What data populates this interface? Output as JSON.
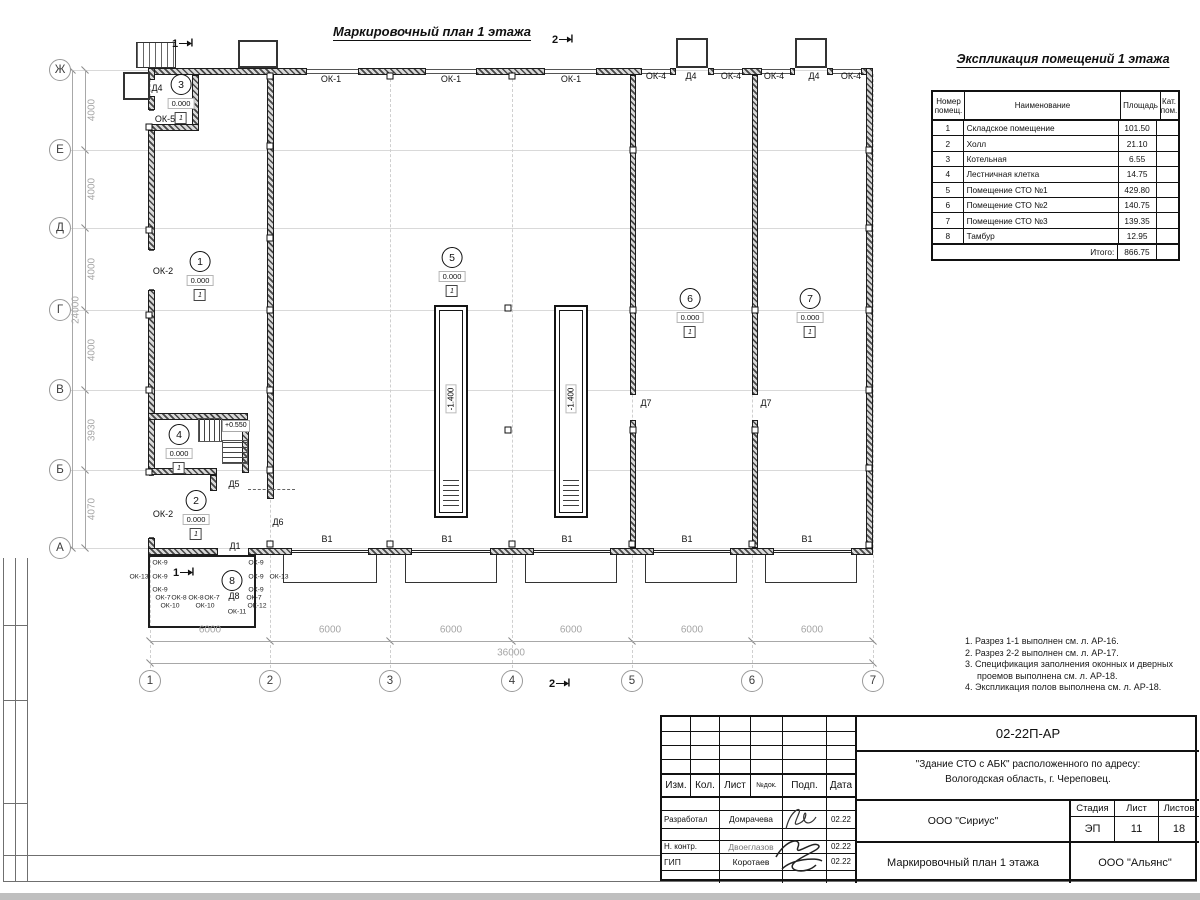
{
  "sheet": {
    "plan_title": "Маркировочный план 1 этажа",
    "table_title": "Экспликация помещений 1 этажа"
  },
  "explication": {
    "headers": {
      "num": "Номер помещ.",
      "name": "Наименование",
      "area": "Площадь",
      "cat": "Кат. пом."
    },
    "rows": [
      {
        "num": "1",
        "name": "Складское помещение",
        "area": "101.50",
        "cat": ""
      },
      {
        "num": "2",
        "name": "Холл",
        "area": "21.10",
        "cat": ""
      },
      {
        "num": "3",
        "name": "Котельная",
        "area": "6.55",
        "cat": ""
      },
      {
        "num": "4",
        "name": "Лестничная клетка",
        "area": "14.75",
        "cat": ""
      },
      {
        "num": "5",
        "name": "Помещение СТО №1",
        "area": "429.80",
        "cat": ""
      },
      {
        "num": "6",
        "name": "Помещение СТО №2",
        "area": "140.75",
        "cat": ""
      },
      {
        "num": "7",
        "name": "Помещение СТО №3",
        "area": "139.35",
        "cat": ""
      },
      {
        "num": "8",
        "name": "Тамбур",
        "area": "12.95",
        "cat": ""
      }
    ],
    "total_label": "Итого:",
    "total_value": "866.75"
  },
  "notes": [
    "1. Разрез 1-1 выполнен см. л. АР-16.",
    "2. Разрез 2-2 выполнен см. л. АР-17.",
    "3. Спецификация заполнения оконных и дверных проемов выполнена см. л. АР-18.",
    "4. Экспликация полов выполнена см. л. АР-18."
  ],
  "title_block": {
    "doc_number": "02-22П-АР",
    "project_line1": "\"Здание СТО с АБК\" расположенного по адресу:",
    "project_line2": "Вологодская область, г. Череповец.",
    "col_izm": "Изм.",
    "col_kol": "Кол.",
    "col_list": "Лист",
    "col_ndok": "№док.",
    "col_podp": "Подп.",
    "col_data": "Дата",
    "rows": [
      {
        "role": "Разработал",
        "name": "Домрачева",
        "date": "02.22"
      },
      {
        "role": "Н. контр.",
        "name": "Двоеглазов",
        "date": "02.22"
      },
      {
        "role": "ГИП",
        "name": "Коротаев",
        "date": "02.22"
      }
    ],
    "org_designer": "ООО \"Сириус\"",
    "org_customer": "ООО \"Альянс\"",
    "stage_label": "Стадия",
    "sheet_label": "Лист",
    "sheets_label": "Листов",
    "stage": "ЭП",
    "sheet_no": "11",
    "sheets_total": "18",
    "drawing_title": "Маркировочный план 1 этажа"
  },
  "plan": {
    "stair_level": "+0.550",
    "grid_h": [
      {
        "x": 71,
        "y": 70,
        "w": 800
      },
      {
        "x": 71,
        "y": 150,
        "w": 800
      },
      {
        "x": 71,
        "y": 228,
        "w": 800
      },
      {
        "x": 71,
        "y": 310,
        "w": 800
      },
      {
        "x": 71,
        "y": 390,
        "w": 800
      },
      {
        "x": 71,
        "y": 470,
        "w": 800
      },
      {
        "x": 71,
        "y": 548,
        "w": 800
      }
    ],
    "grid_v": [
      {
        "x": 150,
        "y": 74,
        "h": 594
      },
      {
        "x": 270,
        "y": 74,
        "h": 594
      },
      {
        "x": 390,
        "y": 74,
        "h": 594
      },
      {
        "x": 512,
        "y": 74,
        "h": 594
      },
      {
        "x": 632,
        "y": 74,
        "h": 594
      },
      {
        "x": 752,
        "y": 74,
        "h": 594
      },
      {
        "x": 873,
        "y": 74,
        "h": 594
      }
    ],
    "axes": [
      {
        "t": "Ж",
        "x": 60,
        "y": 70
      },
      {
        "t": "Е",
        "x": 60,
        "y": 150
      },
      {
        "t": "Д",
        "x": 60,
        "y": 228
      },
      {
        "t": "Г",
        "x": 60,
        "y": 310
      },
      {
        "t": "В",
        "x": 60,
        "y": 390
      },
      {
        "t": "Б",
        "x": 60,
        "y": 470
      },
      {
        "t": "А",
        "x": 60,
        "y": 548
      },
      {
        "t": "1",
        "x": 150,
        "y": 681
      },
      {
        "t": "2",
        "x": 270,
        "y": 681
      },
      {
        "t": "3",
        "x": 390,
        "y": 681
      },
      {
        "t": "4",
        "x": 512,
        "y": 681
      },
      {
        "t": "5",
        "x": 632,
        "y": 681
      },
      {
        "t": "6",
        "x": 752,
        "y": 681
      },
      {
        "t": "7",
        "x": 873,
        "y": 681
      }
    ],
    "dims": [
      {
        "t": "4000",
        "x": 92,
        "y": 110,
        "c": "rot"
      },
      {
        "t": "4000",
        "x": 92,
        "y": 189,
        "c": "rot"
      },
      {
        "t": "4000",
        "x": 92,
        "y": 269,
        "c": "rot"
      },
      {
        "t": "4000",
        "x": 92,
        "y": 350,
        "c": "rot"
      },
      {
        "t": "3930",
        "x": 92,
        "y": 430,
        "c": "rot"
      },
      {
        "t": "4070",
        "x": 92,
        "y": 509,
        "c": "rot"
      },
      {
        "t": "24000",
        "x": 76,
        "y": 310,
        "c": "rot"
      },
      {
        "t": "6000",
        "x": 210,
        "y": 630
      },
      {
        "t": "6000",
        "x": 330,
        "y": 630
      },
      {
        "t": "6000",
        "x": 451,
        "y": 630
      },
      {
        "t": "6000",
        "x": 571,
        "y": 630
      },
      {
        "t": "6000",
        "x": 692,
        "y": 630
      },
      {
        "t": "6000",
        "x": 812,
        "y": 630
      },
      {
        "t": "36000",
        "x": 511,
        "y": 653
      }
    ],
    "ticks": [
      {
        "x": 85,
        "y": 70
      },
      {
        "x": 85,
        "y": 150
      },
      {
        "x": 85,
        "y": 228
      },
      {
        "x": 85,
        "y": 310
      },
      {
        "x": 85,
        "y": 390
      },
      {
        "x": 85,
        "y": 470
      },
      {
        "x": 85,
        "y": 548
      },
      {
        "x": 72,
        "y": 70
      },
      {
        "x": 72,
        "y": 548
      },
      {
        "x": 150,
        "y": 641
      },
      {
        "x": 270,
        "y": 641
      },
      {
        "x": 390,
        "y": 641
      },
      {
        "x": 512,
        "y": 641
      },
      {
        "x": 632,
        "y": 641
      },
      {
        "x": 752,
        "y": 641
      },
      {
        "x": 873,
        "y": 641
      },
      {
        "x": 150,
        "y": 663
      },
      {
        "x": 873,
        "y": 663
      }
    ],
    "walls": [
      {
        "x": 85,
        "y": 70,
        "w": 1,
        "h": 478,
        "c": "dlv"
      },
      {
        "x": 72,
        "y": 70,
        "w": 1,
        "h": 478,
        "c": "dlv"
      },
      {
        "x": 150,
        "y": 641,
        "w": 723,
        "h": 1,
        "c": "dlh"
      },
      {
        "x": 150,
        "y": 663,
        "w": 723,
        "h": 1,
        "c": "dlh"
      },
      {
        "x": 150,
        "y": 68,
        "w": 157,
        "h": 7,
        "c": "wh"
      },
      {
        "x": 358,
        "y": 68,
        "w": 68,
        "h": 7,
        "c": "wh"
      },
      {
        "x": 476,
        "y": 68,
        "w": 69,
        "h": 7,
        "c": "wh"
      },
      {
        "x": 596,
        "y": 68,
        "w": 46,
        "h": 7,
        "c": "wh"
      },
      {
        "x": 670,
        "y": 68,
        "w": 6,
        "h": 7,
        "c": "wh"
      },
      {
        "x": 708,
        "y": 68,
        "w": 6,
        "h": 7,
        "c": "wh"
      },
      {
        "x": 742,
        "y": 68,
        "w": 20,
        "h": 7,
        "c": "wh"
      },
      {
        "x": 790,
        "y": 68,
        "w": 5,
        "h": 7,
        "c": "wh"
      },
      {
        "x": 827,
        "y": 68,
        "w": 6,
        "h": 7,
        "c": "wh"
      },
      {
        "x": 861,
        "y": 68,
        "w": 12,
        "h": 7,
        "c": "wh"
      },
      {
        "x": 307,
        "y": 69,
        "w": 51,
        "h": 5,
        "c": "wt"
      },
      {
        "x": 426,
        "y": 69,
        "w": 50,
        "h": 5,
        "c": "wt"
      },
      {
        "x": 545,
        "y": 69,
        "w": 51,
        "h": 5,
        "c": "wt"
      },
      {
        "x": 642,
        "y": 69,
        "w": 28,
        "h": 5,
        "c": "wt"
      },
      {
        "x": 714,
        "y": 69,
        "w": 28,
        "h": 5,
        "c": "wt"
      },
      {
        "x": 762,
        "y": 69,
        "w": 28,
        "h": 5,
        "c": "wt"
      },
      {
        "x": 833,
        "y": 69,
        "w": 28,
        "h": 5,
        "c": "wt"
      },
      {
        "x": 148,
        "y": 68,
        "w": 7,
        "h": 12,
        "c": "wh"
      },
      {
        "x": 148,
        "y": 96,
        "w": 7,
        "h": 14,
        "c": "wh"
      },
      {
        "x": 148,
        "y": 127,
        "w": 7,
        "h": 123,
        "c": "wh"
      },
      {
        "x": 148,
        "y": 290,
        "w": 7,
        "h": 185,
        "c": "wh"
      },
      {
        "x": 148,
        "y": 538,
        "w": 7,
        "h": 17,
        "c": "wh"
      },
      {
        "x": 149,
        "y": 110,
        "w": 5,
        "h": 17,
        "c": "wt"
      },
      {
        "x": 149,
        "y": 250,
        "w": 5,
        "h": 40,
        "c": "wt"
      },
      {
        "x": 149,
        "y": 475,
        "w": 5,
        "h": 63,
        "c": "wt"
      },
      {
        "x": 866,
        "y": 68,
        "w": 7,
        "h": 487,
        "c": "wh"
      },
      {
        "x": 148,
        "y": 548,
        "w": 70,
        "h": 7,
        "c": "wh"
      },
      {
        "x": 248,
        "y": 548,
        "w": 44,
        "h": 7,
        "c": "wh"
      },
      {
        "x": 368,
        "y": 548,
        "w": 44,
        "h": 7,
        "c": "wh"
      },
      {
        "x": 490,
        "y": 548,
        "w": 44,
        "h": 7,
        "c": "wh"
      },
      {
        "x": 610,
        "y": 548,
        "w": 44,
        "h": 7,
        "c": "wh"
      },
      {
        "x": 730,
        "y": 548,
        "w": 44,
        "h": 7,
        "c": "wh"
      },
      {
        "x": 851,
        "y": 548,
        "w": 22,
        "h": 7,
        "c": "wh"
      },
      {
        "x": 292,
        "y": 550,
        "w": 76,
        "h": 3,
        "c": "gate"
      },
      {
        "x": 412,
        "y": 550,
        "w": 78,
        "h": 3,
        "c": "gate"
      },
      {
        "x": 534,
        "y": 550,
        "w": 76,
        "h": 3,
        "c": "gate"
      },
      {
        "x": 654,
        "y": 550,
        "w": 76,
        "h": 3,
        "c": "gate"
      },
      {
        "x": 774,
        "y": 550,
        "w": 77,
        "h": 3,
        "c": "gate"
      },
      {
        "x": 283,
        "y": 555,
        "w": 94,
        "h": 28,
        "c": "apron"
      },
      {
        "x": 405,
        "y": 555,
        "w": 92,
        "h": 28,
        "c": "apron"
      },
      {
        "x": 525,
        "y": 555,
        "w": 92,
        "h": 28,
        "c": "apron"
      },
      {
        "x": 645,
        "y": 555,
        "w": 92,
        "h": 28,
        "c": "apron"
      },
      {
        "x": 765,
        "y": 555,
        "w": 92,
        "h": 28,
        "c": "apron"
      },
      {
        "x": 148,
        "y": 555,
        "w": 108,
        "h": 73,
        "c": "tam"
      },
      {
        "x": 267,
        "y": 75,
        "w": 7,
        "h": 424,
        "c": "wh"
      },
      {
        "x": 630,
        "y": 75,
        "w": 6,
        "h": 320,
        "c": "wh"
      },
      {
        "x": 630,
        "y": 420,
        "w": 6,
        "h": 128,
        "c": "wh"
      },
      {
        "x": 752,
        "y": 75,
        "w": 6,
        "h": 320,
        "c": "wh"
      },
      {
        "x": 752,
        "y": 420,
        "w": 6,
        "h": 128,
        "c": "wh"
      },
      {
        "x": 192,
        "y": 75,
        "w": 7,
        "h": 53,
        "c": "wh"
      },
      {
        "x": 148,
        "y": 124,
        "w": 51,
        "h": 7,
        "c": "wh"
      },
      {
        "x": 148,
        "y": 413,
        "w": 100,
        "h": 7,
        "c": "wh"
      },
      {
        "x": 242,
        "y": 420,
        "w": 7,
        "h": 53,
        "c": "wh"
      },
      {
        "x": 148,
        "y": 468,
        "w": 69,
        "h": 7,
        "c": "wh"
      },
      {
        "x": 210,
        "y": 475,
        "w": 7,
        "h": 16,
        "c": "wh"
      },
      {
        "x": 248,
        "y": 489,
        "w": 47,
        "h": 2,
        "c": "dash"
      },
      {
        "x": 123,
        "y": 72,
        "w": 27,
        "h": 28,
        "c": "box"
      },
      {
        "x": 238,
        "y": 40,
        "w": 40,
        "h": 28,
        "c": "box"
      },
      {
        "x": 676,
        "y": 38,
        "w": 32,
        "h": 30,
        "c": "box"
      },
      {
        "x": 795,
        "y": 38,
        "w": 32,
        "h": 30,
        "c": "box"
      },
      {
        "x": 136,
        "y": 42,
        "w": 40,
        "h": 26,
        "c": "stx"
      }
    ],
    "squares": [
      {
        "x": 270,
        "y": 76
      },
      {
        "x": 390,
        "y": 76
      },
      {
        "x": 512,
        "y": 76
      },
      {
        "x": 149,
        "y": 127
      },
      {
        "x": 149,
        "y": 230
      },
      {
        "x": 149,
        "y": 315
      },
      {
        "x": 149,
        "y": 390
      },
      {
        "x": 149,
        "y": 472
      },
      {
        "x": 270,
        "y": 146
      },
      {
        "x": 270,
        "y": 238
      },
      {
        "x": 270,
        "y": 310
      },
      {
        "x": 270,
        "y": 390
      },
      {
        "x": 270,
        "y": 470
      },
      {
        "x": 633,
        "y": 150
      },
      {
        "x": 633,
        "y": 310
      },
      {
        "x": 633,
        "y": 430
      },
      {
        "x": 755,
        "y": 310
      },
      {
        "x": 755,
        "y": 430
      },
      {
        "x": 869,
        "y": 150
      },
      {
        "x": 869,
        "y": 228
      },
      {
        "x": 869,
        "y": 310
      },
      {
        "x": 869,
        "y": 390
      },
      {
        "x": 869,
        "y": 468
      },
      {
        "x": 869,
        "y": 545
      },
      {
        "x": 270,
        "y": 544
      },
      {
        "x": 390,
        "y": 544
      },
      {
        "x": 512,
        "y": 544
      },
      {
        "x": 632,
        "y": 544
      },
      {
        "x": 752,
        "y": 544
      },
      {
        "x": 508,
        "y": 308
      },
      {
        "x": 508,
        "y": 430
      }
    ],
    "rooms": [
      {
        "num": "1",
        "x": 200,
        "y": 261,
        "level": "0.000",
        "icon": "1"
      },
      {
        "num": "2",
        "x": 196,
        "y": 500,
        "level": "0.000",
        "icon": "1"
      },
      {
        "num": "3",
        "x": 181,
        "y": 84,
        "level": "0.000",
        "icon": "1"
      },
      {
        "num": "4",
        "x": 179,
        "y": 434,
        "level": "0.000",
        "icon": "1"
      },
      {
        "num": "5",
        "x": 452,
        "y": 257,
        "level": "0.000",
        "icon": "1"
      },
      {
        "num": "6",
        "x": 690,
        "y": 298,
        "level": "0.000",
        "icon": "1"
      },
      {
        "num": "7",
        "x": 810,
        "y": 298,
        "level": "0.000",
        "icon": "1"
      },
      {
        "num": "8",
        "x": 232,
        "y": 580,
        "level": "",
        "icon": ""
      }
    ],
    "pits": [
      {
        "x": 434,
        "y": 305,
        "level": "-1.400"
      },
      {
        "x": 554,
        "y": 305,
        "level": "-1.400"
      }
    ],
    "sections": [
      {
        "t": "1",
        "x": 183,
        "y": 44
      },
      {
        "t": "1",
        "x": 184,
        "y": 573
      },
      {
        "t": "2",
        "x": 563,
        "y": 40
      },
      {
        "t": "2",
        "x": 560,
        "y": 684
      }
    ],
    "labels": [
      {
        "t": "ОК-1",
        "x": 331,
        "y": 79
      },
      {
        "t": "ОК-1",
        "x": 451,
        "y": 79
      },
      {
        "t": "ОК-1",
        "x": 571,
        "y": 79
      },
      {
        "t": "ОК-4",
        "x": 656,
        "y": 76
      },
      {
        "t": "Д4",
        "x": 691,
        "y": 76
      },
      {
        "t": "ОК-4",
        "x": 731,
        "y": 76
      },
      {
        "t": "ОК-4",
        "x": 774,
        "y": 76
      },
      {
        "t": "Д4",
        "x": 814,
        "y": 76
      },
      {
        "t": "ОК-4",
        "x": 851,
        "y": 76
      },
      {
        "t": "Д4",
        "x": 157,
        "y": 88
      },
      {
        "t": "ОК-5",
        "x": 165,
        "y": 119
      },
      {
        "t": "ОК-2",
        "x": 163,
        "y": 271
      },
      {
        "t": "ОК-2",
        "x": 163,
        "y": 514
      },
      {
        "t": "Д5",
        "x": 234,
        "y": 484
      },
      {
        "t": "Д6",
        "x": 278,
        "y": 522
      },
      {
        "t": "Д1",
        "x": 235,
        "y": 546
      },
      {
        "t": "Д7",
        "x": 646,
        "y": 403
      },
      {
        "t": "Д7",
        "x": 766,
        "y": 403
      },
      {
        "t": "В1",
        "x": 327,
        "y": 539
      },
      {
        "t": "В1",
        "x": 447,
        "y": 539
      },
      {
        "t": "В1",
        "x": 567,
        "y": 539
      },
      {
        "t": "В1",
        "x": 687,
        "y": 539
      },
      {
        "t": "В1",
        "x": 807,
        "y": 539
      },
      {
        "t": "Д8",
        "x": 234,
        "y": 596
      },
      {
        "t": "ОК-9",
        "x": 160,
        "y": 563,
        "c": "sm"
      },
      {
        "t": "ОК-9",
        "x": 160,
        "y": 577,
        "c": "sm"
      },
      {
        "t": "ОК-9",
        "x": 160,
        "y": 590,
        "c": "sm"
      },
      {
        "t": "ОК-9",
        "x": 256,
        "y": 563,
        "c": "sm"
      },
      {
        "t": "ОК-9",
        "x": 256,
        "y": 577,
        "c": "sm"
      },
      {
        "t": "ОК-9",
        "x": 256,
        "y": 590,
        "c": "sm"
      },
      {
        "t": "ОК-13",
        "x": 139,
        "y": 577,
        "c": "sm"
      },
      {
        "t": "ОК-13",
        "x": 279,
        "y": 577,
        "c": "sm"
      },
      {
        "t": "ОК-7",
        "x": 163,
        "y": 598,
        "c": "sm"
      },
      {
        "t": "ОК-8",
        "x": 179,
        "y": 598,
        "c": "sm"
      },
      {
        "t": "ОК-8",
        "x": 196,
        "y": 598,
        "c": "sm"
      },
      {
        "t": "ОК-7",
        "x": 212,
        "y": 598,
        "c": "sm"
      },
      {
        "t": "ОК-7",
        "x": 254,
        "y": 598,
        "c": "sm"
      },
      {
        "t": "ОК-10",
        "x": 170,
        "y": 606,
        "c": "sm"
      },
      {
        "t": "ОК-10",
        "x": 205,
        "y": 606,
        "c": "sm"
      },
      {
        "t": "ОК-11",
        "x": 237,
        "y": 612,
        "c": "sm"
      },
      {
        "t": "ОК-12",
        "x": 257,
        "y": 606,
        "c": "sm"
      }
    ]
  }
}
